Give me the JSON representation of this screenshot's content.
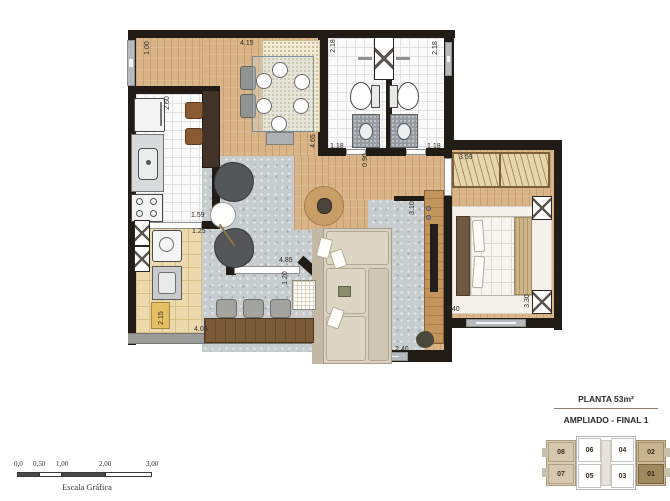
{
  "legend": {
    "title": "PLANTA 53m²",
    "subtitle": "AMPLIADO - FINAL 1"
  },
  "key_plan": {
    "units": [
      "08",
      "06",
      "04",
      "02",
      "07",
      "05",
      "03",
      "01"
    ],
    "highlighted_unit": "01"
  },
  "scale_bar": {
    "ticks": [
      "0,0",
      "0,50",
      "1,00",
      "2,00",
      "3,00"
    ],
    "label": "Escala Gráfica"
  },
  "dimensions": [
    {
      "value": "1.00",
      "x": 141,
      "y": 44,
      "o": "v"
    },
    {
      "value": "4.15",
      "x": 240,
      "y": 40,
      "o": "h"
    },
    {
      "value": "2.18",
      "x": 327,
      "y": 42,
      "o": "v"
    },
    {
      "value": "2.18",
      "x": 429,
      "y": 44,
      "o": "v"
    },
    {
      "value": "2.60",
      "x": 161,
      "y": 99,
      "o": "v"
    },
    {
      "value": "4.65",
      "x": 307,
      "y": 137,
      "o": "v"
    },
    {
      "value": "1.18",
      "x": 330,
      "y": 143,
      "o": "h"
    },
    {
      "value": "1.18",
      "x": 427,
      "y": 143,
      "o": "h"
    },
    {
      "value": "0.90",
      "x": 359,
      "y": 156,
      "o": "v"
    },
    {
      "value": "3.59",
      "x": 459,
      "y": 154,
      "o": "h"
    },
    {
      "value": "3.10",
      "x": 406,
      "y": 204,
      "o": "v"
    },
    {
      "value": "1.59",
      "x": 191,
      "y": 212,
      "o": "h"
    },
    {
      "value": "1.25",
      "x": 192,
      "y": 228,
      "o": "h"
    },
    {
      "value": "4.85",
      "x": 279,
      "y": 257,
      "o": "h"
    },
    {
      "value": "1.20",
      "x": 279,
      "y": 274,
      "o": "v"
    },
    {
      "value": "2.15",
      "x": 155,
      "y": 314,
      "o": "v"
    },
    {
      "value": "4.05",
      "x": 194,
      "y": 326,
      "o": "h"
    },
    {
      "value": "2.40",
      "x": 446,
      "y": 306,
      "o": "h"
    },
    {
      "value": "3.30",
      "x": 521,
      "y": 297,
      "o": "v"
    },
    {
      "value": "2.40",
      "x": 395,
      "y": 346,
      "o": "h"
    }
  ],
  "colors": {
    "wall": "#221c17",
    "wood_floor": "#d9b487",
    "terrace_tile": "#ecdaae",
    "living_rug": "#c7cccf",
    "highlight_unit": "#9f8960",
    "wing_tan": "#d6c8ae"
  }
}
